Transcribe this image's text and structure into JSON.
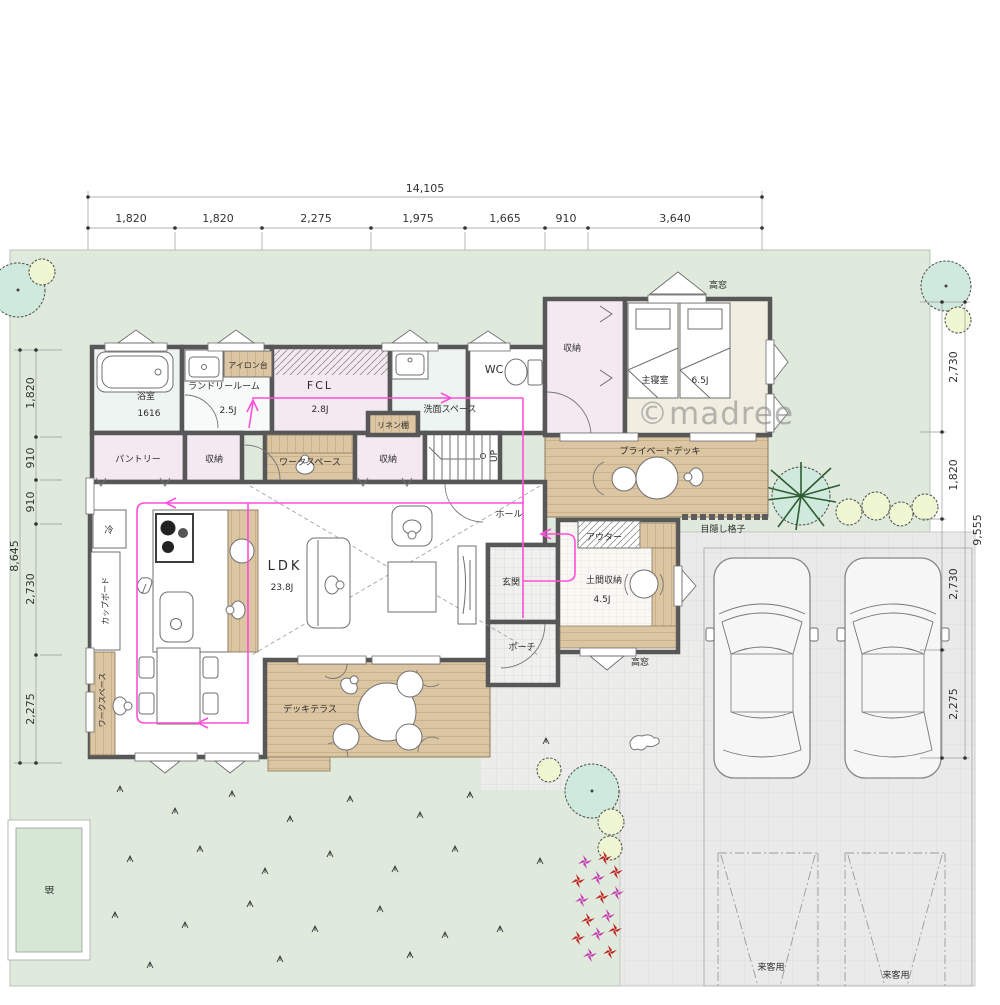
{
  "watermark": "©madree",
  "dimensions": {
    "top": {
      "total": "14,105",
      "segments": [
        "1,820",
        "1,820",
        "2,275",
        "1,975",
        "1,665",
        "910",
        "3,640"
      ]
    },
    "left": {
      "total": "8,645",
      "segments": [
        "1,820",
        "910",
        "910",
        "2,730",
        "2,275"
      ]
    },
    "right": {
      "total": "9,555",
      "segments": [
        "2,730",
        "1,820",
        "2,730",
        "2,275"
      ]
    }
  },
  "rooms": {
    "bathroom": {
      "name": "浴室",
      "size": "1616"
    },
    "laundry": {
      "name": "ランドリールーム",
      "size": "2.5J"
    },
    "ironing_board": "アイロン台",
    "fcl": {
      "name": "FCL",
      "size": "2.8J"
    },
    "wash_space": "洗面スペース",
    "wc": "WC",
    "closet1": "収納",
    "bedroom": {
      "name": "主寝室",
      "size": "6.5J"
    },
    "pantry": "パントリー",
    "closet2": "収納",
    "workspace": "ワークスペース",
    "linen_shelf": "リネン棚",
    "closet3": "収納",
    "stairs_up": "UP",
    "hall": "ホール",
    "private_deck": "プライベートデッキ",
    "lattice": "目隠し格子",
    "outer_closet": "アウター",
    "doma_storage": {
      "name": "土間収納",
      "size": "4.5J"
    },
    "genkan": "玄関",
    "porch": "ポーチ",
    "ldk": {
      "name": "LDK",
      "size": "23.8J"
    },
    "cupboard": "カップボード",
    "fridge": "冷",
    "deck_terrace": "デッキテラス",
    "workspace2": "ワークスペース",
    "field": "畑",
    "high_window": "高窓",
    "visitor_parking": "来客用"
  },
  "colors": {
    "wall": "#575757",
    "lawn": "#dfe9dc",
    "deck": "#dbc5a3",
    "deckline": "#c9b188",
    "pink": "#f4e9f0",
    "cream": "#f1eee1",
    "blueish": "#eef4f1",
    "drive": "#eaeaea",
    "accent": "#ff4fd8",
    "treemint": "#cfeadd",
    "treeyellow": "#eef6d2"
  }
}
